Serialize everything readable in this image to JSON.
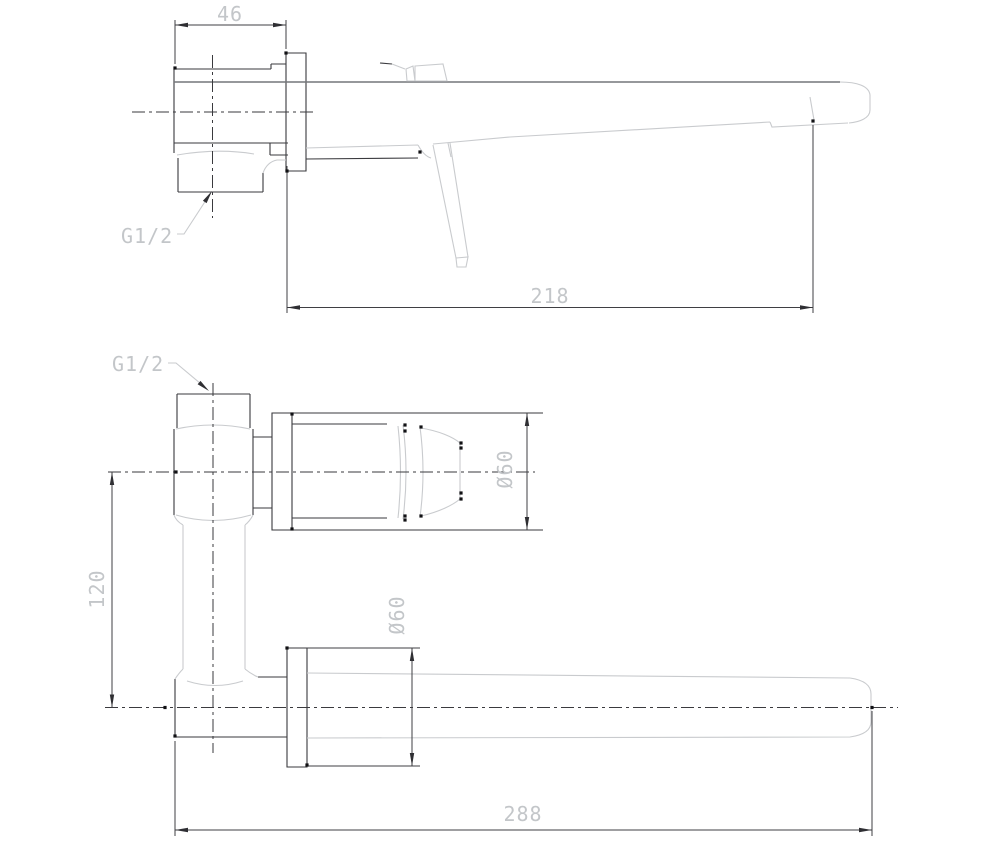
{
  "drawing": {
    "product": "wall-mounted basin mixer",
    "colors": {
      "background": "#ffffff",
      "object_dark": "#3a3a3e",
      "object_medium": "#74767a",
      "object_light": "#c9cbce",
      "dimension_line": "#3f3f43",
      "dimension_text": "#c3c6c9"
    },
    "top_view": {
      "width_mm": "46",
      "length_mm": "218",
      "thread": "G1/2"
    },
    "bottom_view": {
      "thread": "G1/2",
      "handle_diameter": "Ø60",
      "spout_plate_diameter": "Ø60",
      "center_distance_mm": "120",
      "length_mm": "288"
    }
  }
}
